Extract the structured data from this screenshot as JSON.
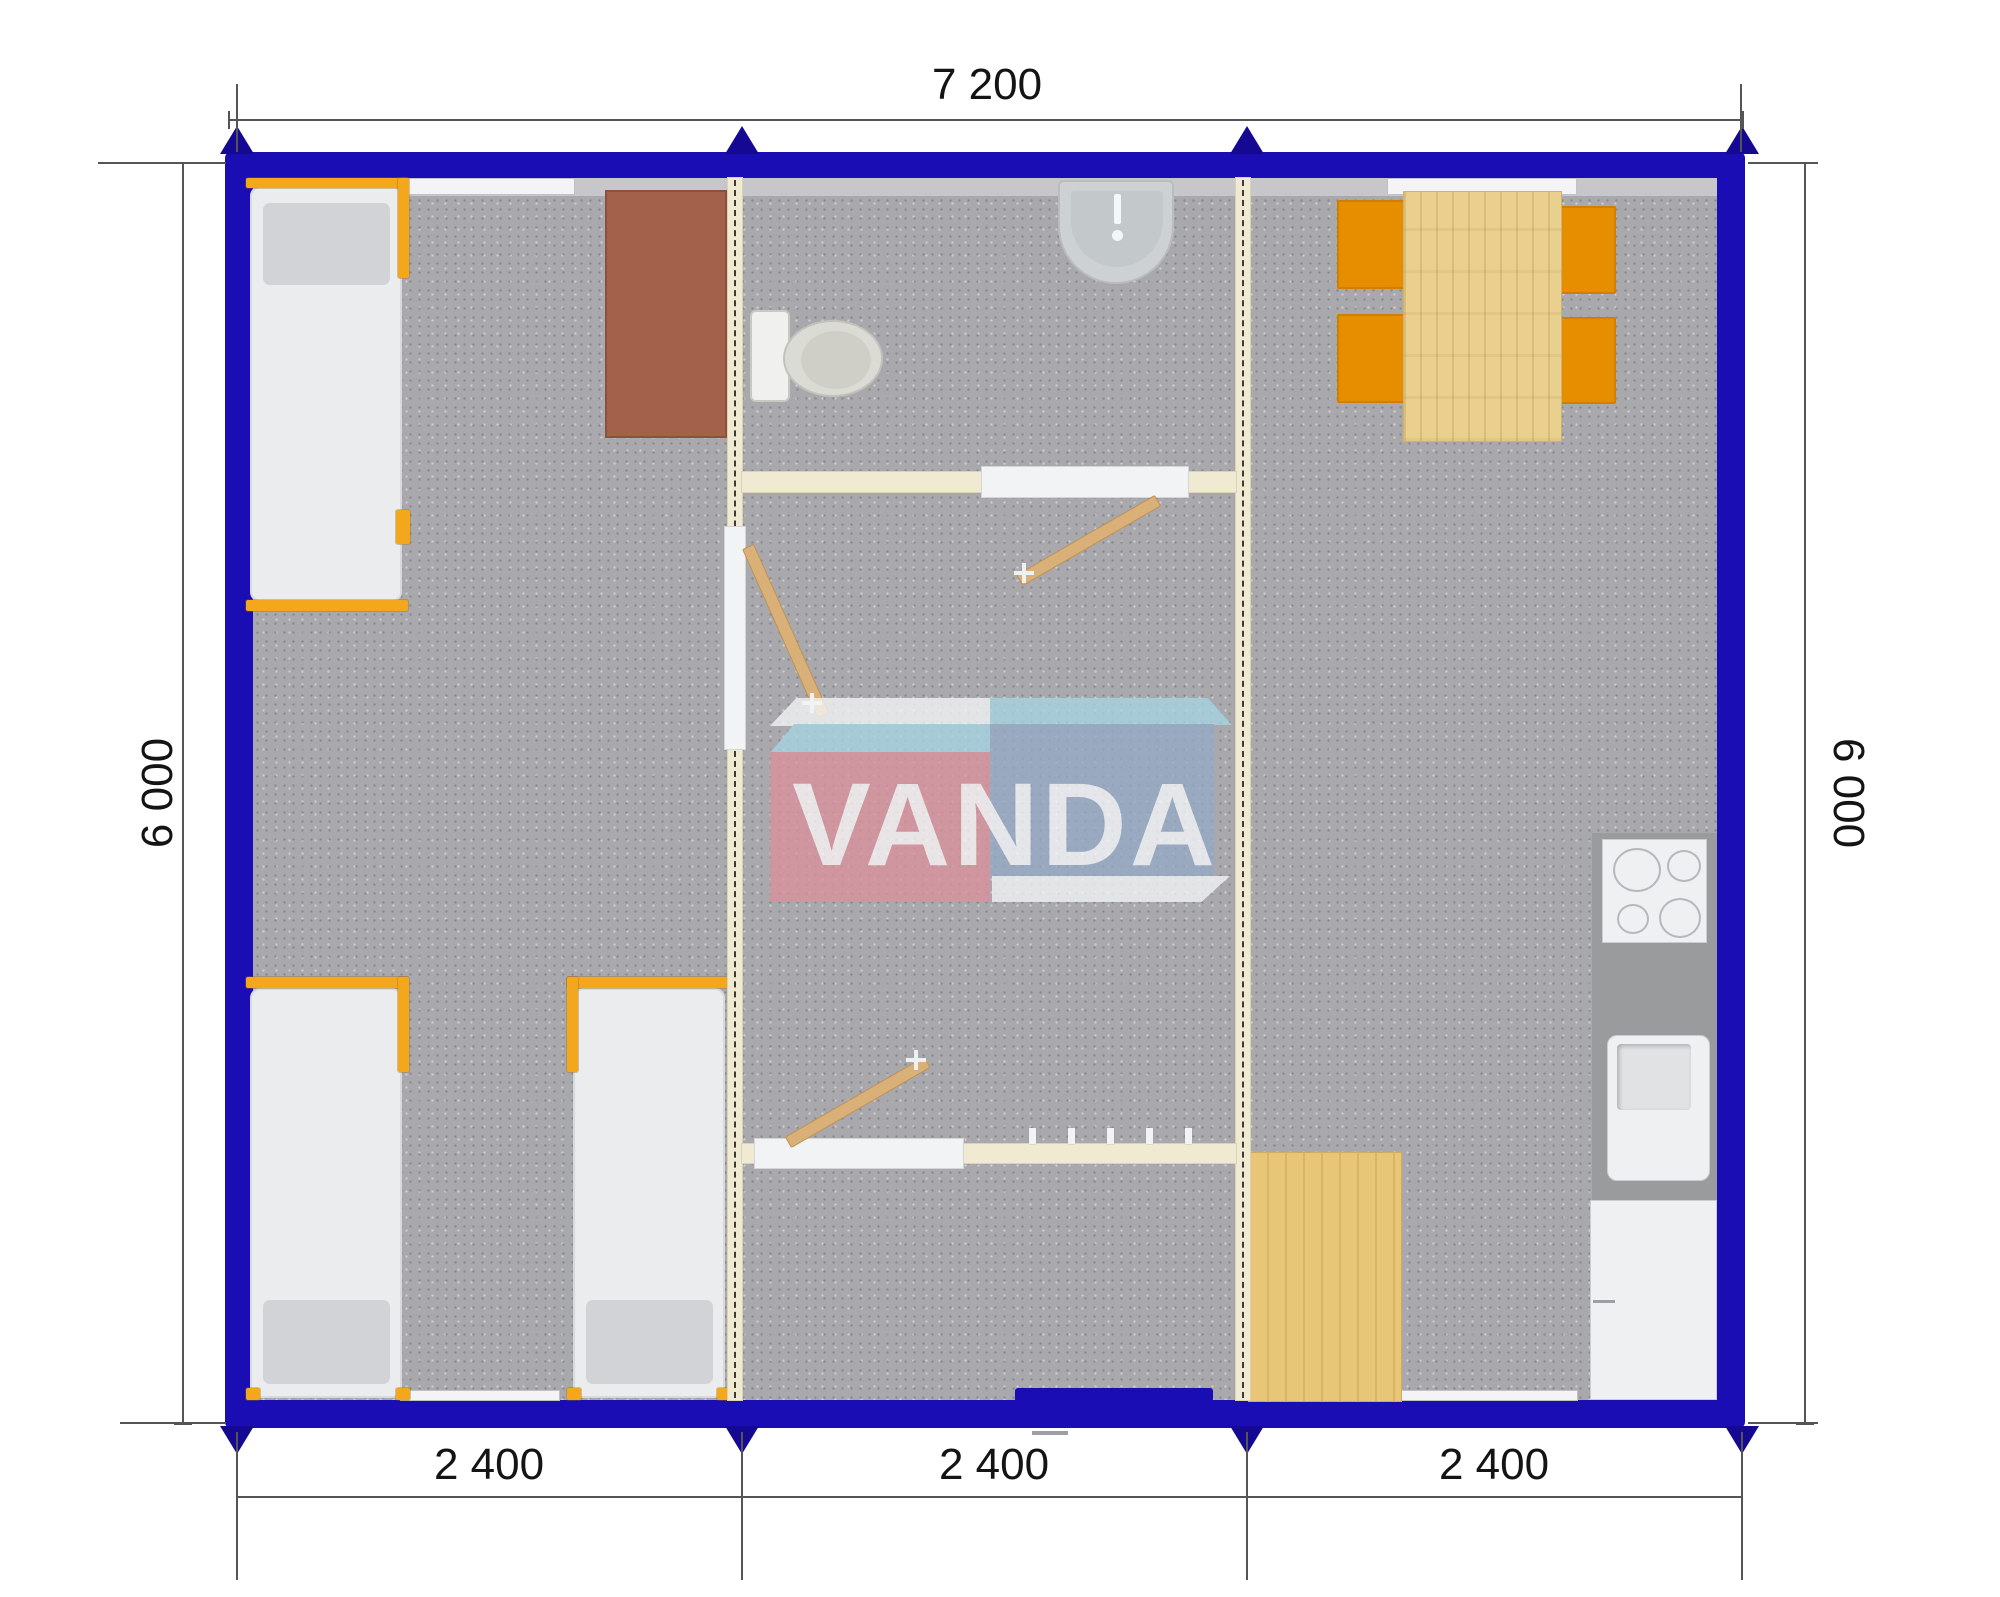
{
  "watermark": {
    "brand": "VANDA"
  },
  "dimensions": {
    "overall_width": "7 200",
    "side_left": "6 000",
    "side_right": "6 000",
    "modules": [
      "2 400",
      "2 400",
      "2 400"
    ]
  },
  "colors": {
    "wall_blue": "#1a0db4",
    "floor_gray": "#a9a9ad",
    "partition_cream": "#f0ead2",
    "bed_frame_orange": "#f2a71c",
    "chair_orange": "#e68d00",
    "table_wood": "#e9d08f",
    "desk_brown": "#a3604b",
    "kitchen_counter": "#9a9b9d",
    "logo_pink": "#da919d",
    "logo_blue": "#95a9c6",
    "logo_sky": "#a6d4e2"
  }
}
